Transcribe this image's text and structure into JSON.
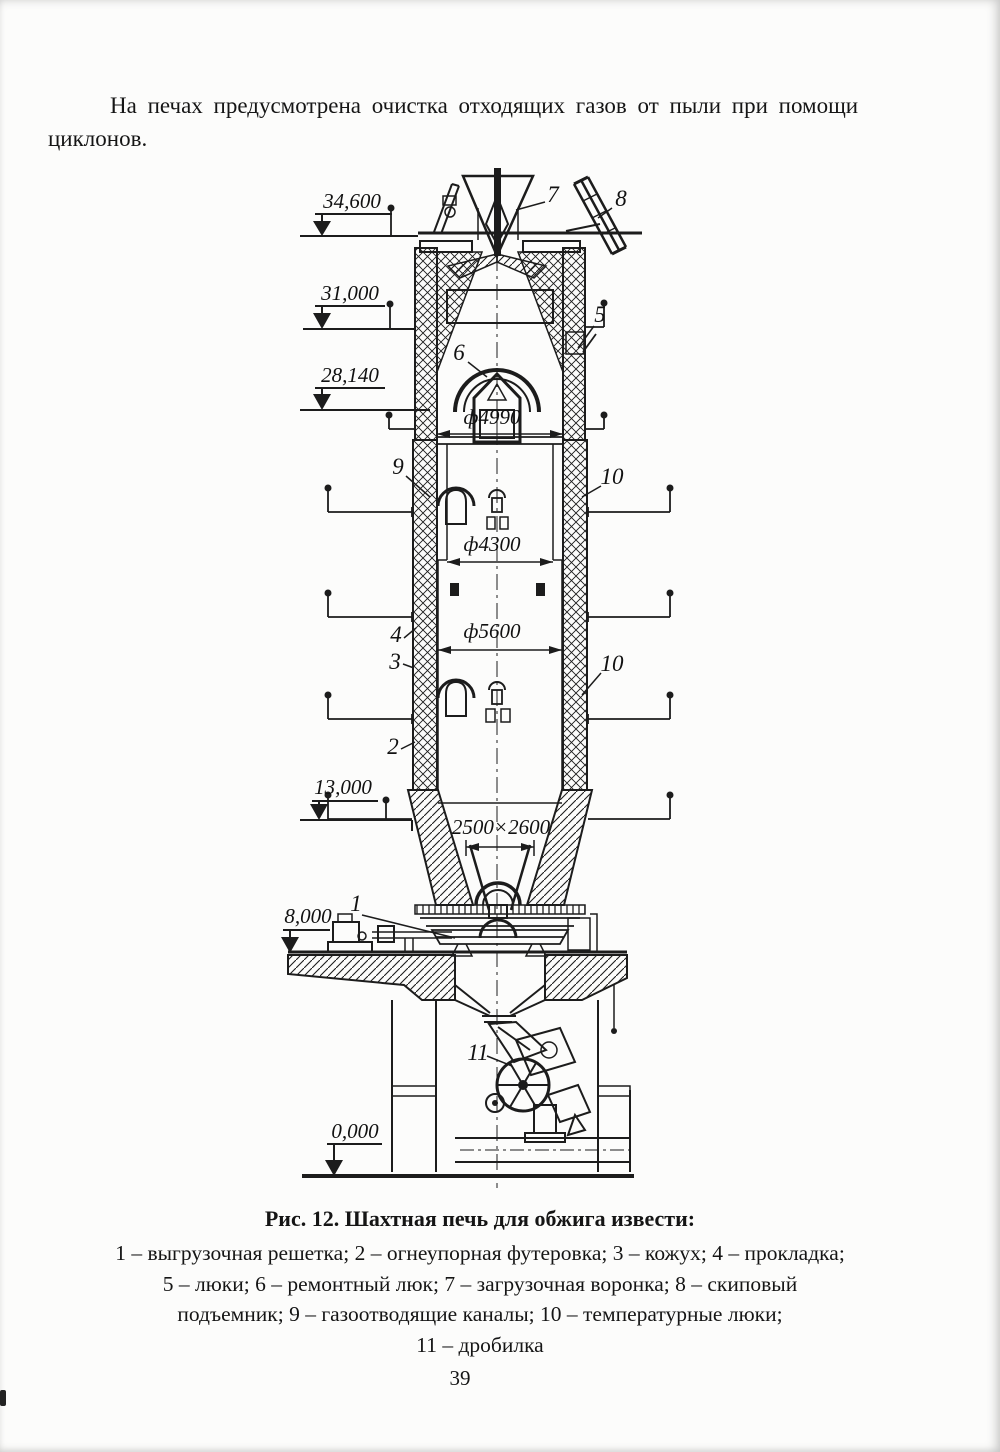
{
  "page": {
    "paragraph_lines": [
      "На печах предусмотрена очистка отходящих газов от пыли при помощи",
      "циклонов."
    ],
    "page_number": "39"
  },
  "figure": {
    "caption": "Рис. 12. Шахтная печь для обжига извести:",
    "legend_lines": [
      "1 – выгрузочная решетка; 2 – огнеупорная футеровка; 3 – кожух; 4 – прокладка;",
      "5 – люки; 6 – ремонтный люк; 7 – загрузочная воронка; 8 – скиповый",
      "подъемник; 9 – газоотводящие каналы; 10 – температурные люки;",
      "11 – дробилка"
    ]
  },
  "diagram": {
    "elevations": {
      "v34600": "34,600",
      "v31000": "31,000",
      "v28140": "28,140",
      "v13000": "13,000",
      "v8000": "8,000",
      "v0": "0,000"
    },
    "dimensions": {
      "d4990": "ф4990",
      "d4300": "ф4300",
      "d5600": "ф5600",
      "opening": "2500×2600"
    },
    "callouts": {
      "c1": "1",
      "c2": "2",
      "c3": "3",
      "c4": "4",
      "c5": "5",
      "c6": "6",
      "c7": "7",
      "c8": "8",
      "c9": "9",
      "c10a": "10",
      "c10b": "10",
      "c11": "11"
    }
  }
}
